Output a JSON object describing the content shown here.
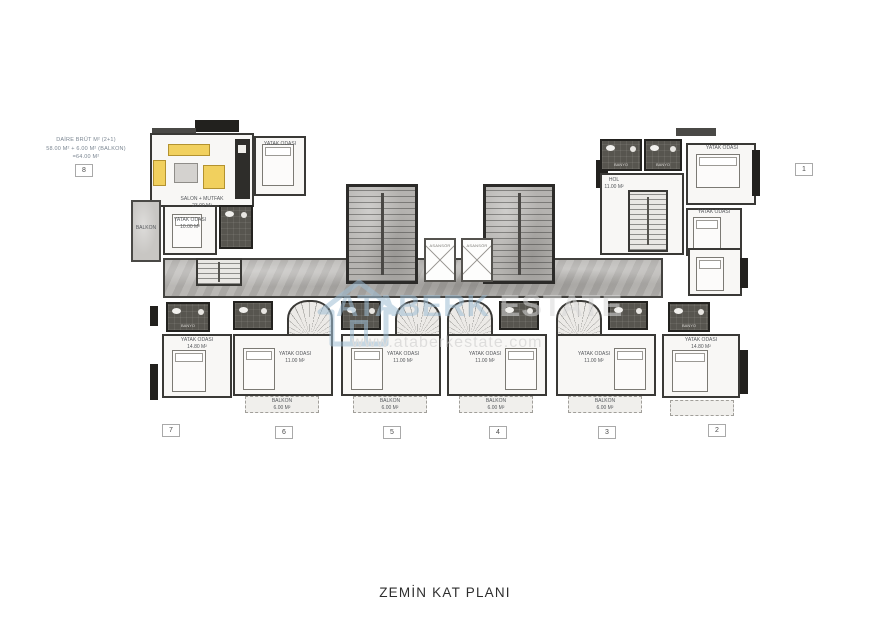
{
  "page": {
    "title": "ZEMİN KAT PLANI"
  },
  "annotation": {
    "line1": "DAİRE BRÜT M² (2+1)",
    "line2": "58.00 M² + 6.00 M² (BALKON)",
    "line3": "=64.00 M²"
  },
  "watermark": {
    "brand_first": "ATABERK",
    "brand_second": "ESTATE",
    "website": "www.ataberkestate.com"
  },
  "units": {
    "badges": [
      "1",
      "2",
      "3",
      "4",
      "5",
      "6",
      "7",
      "8"
    ]
  },
  "labels": {
    "living_room": "SALON + MUTFAK",
    "living_area": "23.00 M²",
    "bedroom": "YATAK ODASI",
    "bedroom_area_mid": "11.00 M²",
    "bedroom_area_small": "10.00 M²",
    "bedroom_area_wing": "14.80 M²",
    "balcony": "BALKON",
    "balcony_area": "6.00 M²",
    "hall": "HOL",
    "hall_area": "11.00 M²",
    "bathroom": "BANYO",
    "elevator": "ASANSÖR"
  },
  "colors": {
    "wall": "#3a3936",
    "marble": "#b2b0ad",
    "tile_dark": "#57554f",
    "furniture_yellow": "#f1d05e",
    "watermark_blue": "#9fbed4",
    "watermark_gray": "#d9d9d9"
  }
}
